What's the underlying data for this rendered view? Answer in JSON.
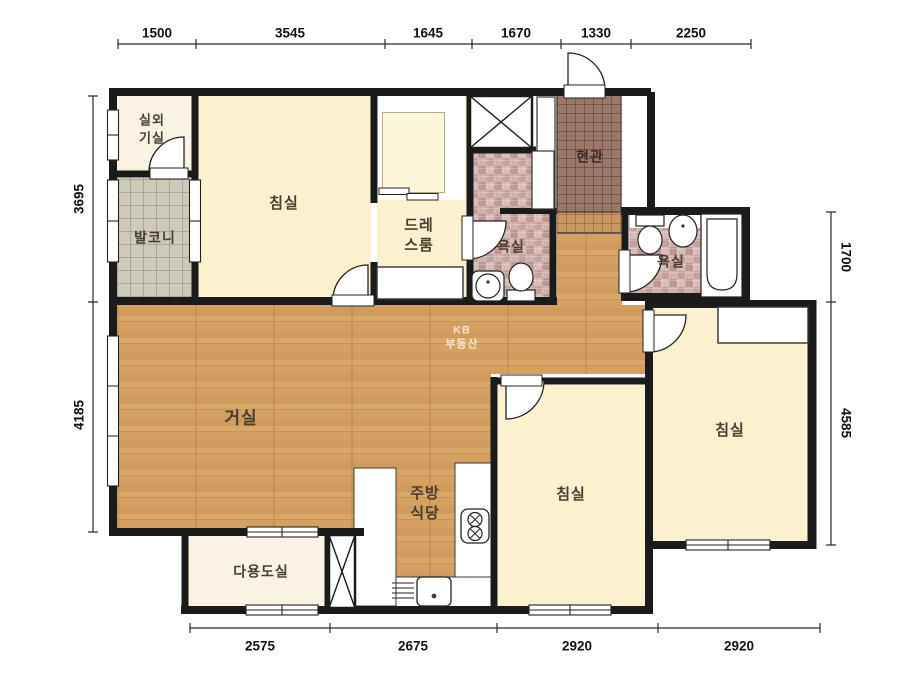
{
  "watermark": {
    "line1": "KB",
    "line2": "부동산"
  },
  "rooms": {
    "outdoor_unit": {
      "line1": "실외",
      "line2": "기실"
    },
    "balcony": {
      "label": "발코니"
    },
    "bedroom1": {
      "label": "침실"
    },
    "dressroom": {
      "line1": "드레",
      "line2": "스룸"
    },
    "bathroom1": {
      "label": "욕실"
    },
    "entrance": {
      "label": "현관"
    },
    "bathroom2": {
      "label": "욕실"
    },
    "living": {
      "label": "거실"
    },
    "kitchen": {
      "line1": "주방",
      "line2": "식당"
    },
    "utility": {
      "label": "다용도실"
    },
    "bedroom2": {
      "label": "침실"
    },
    "bedroom3": {
      "label": "침실"
    }
  },
  "dimensions": {
    "top": [
      "1500",
      "3545",
      "1645",
      "1670",
      "1330",
      "2250"
    ],
    "bottom": [
      "2575",
      "2675",
      "2920",
      "2920"
    ],
    "left": [
      "3695",
      "4185"
    ],
    "right": [
      "1700",
      "4585"
    ]
  },
  "colors": {
    "wall": "#1b1b1b",
    "wood": "#d5a160",
    "cream": "#fbf1ce",
    "cream_pale": "#f8f3e3",
    "closet": "#fdf6d9",
    "balcony": "#cdcaba",
    "entrance_tile": "#9d7769",
    "step_tile": "#cb975f",
    "mosaic": "#cbada9"
  }
}
